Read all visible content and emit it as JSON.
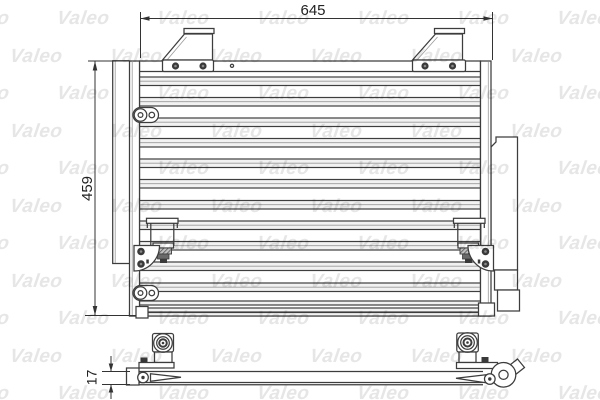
{
  "page": {
    "background": "#ffffff"
  },
  "watermark": {
    "text": "Valeo",
    "color": "#e6e6e6",
    "font_size": 19,
    "rows": 11,
    "cols": 7,
    "row_height": 37.5,
    "col_width": 100,
    "offset_even": -43,
    "offset_odd": -90,
    "y_start": 8
  },
  "drawing": {
    "type": "technical-part-drawing",
    "part": "air-conditioning-condenser",
    "line_color": "#3d3d3d",
    "dimensions": {
      "width": "645",
      "height": "459",
      "depth": "17"
    }
  }
}
